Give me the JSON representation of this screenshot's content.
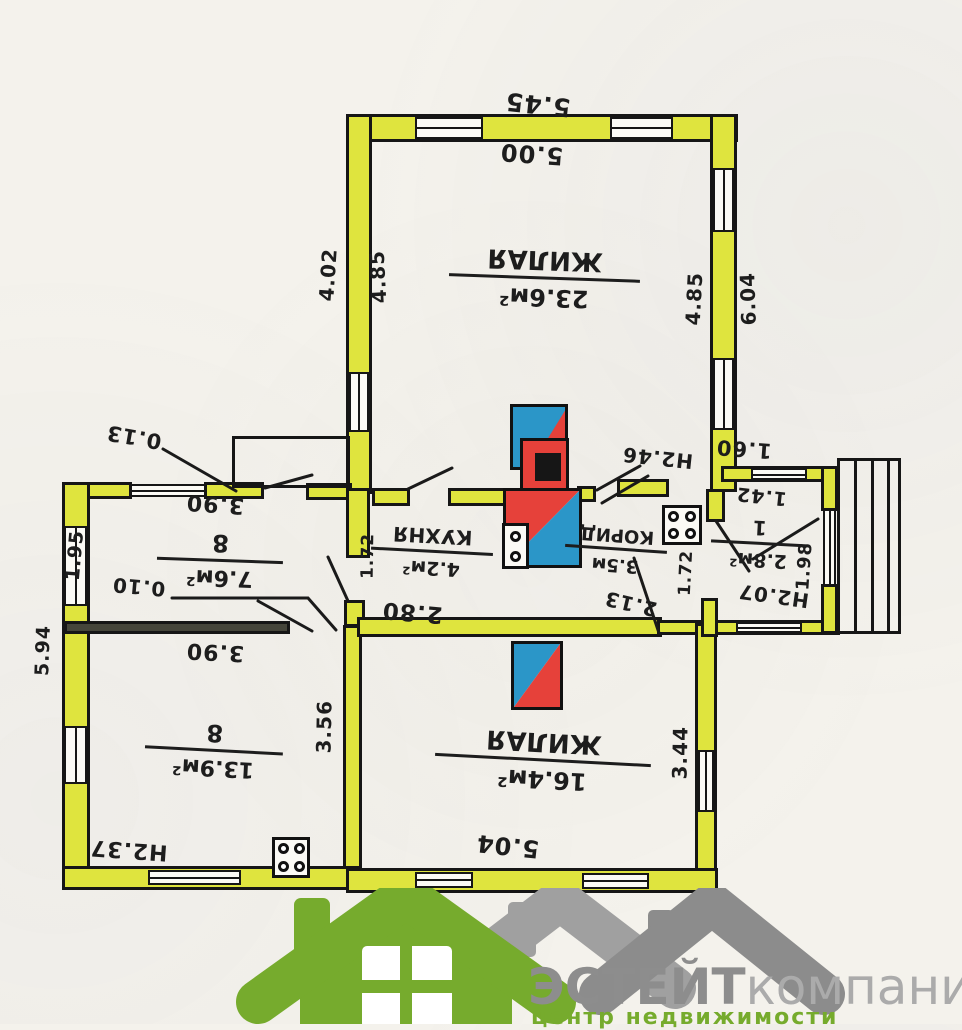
{
  "document": {
    "type": "hand-drawn floor plan (photographed upside down)",
    "orientation_note": "all plan lettering appears rotated 180°"
  },
  "plan": {
    "rooms": {
      "living_main": {
        "name": "ЖИЛАЯ",
        "area": "23.6м²"
      },
      "room_8a": {
        "name": "8",
        "area": "7.6м²"
      },
      "room_8b": {
        "name": "8",
        "area": "13.9м²"
      },
      "kitchen": {
        "name": "КУХНЯ",
        "area": "4.2м²"
      },
      "corridor": {
        "name": "КОРИД",
        "area": "3.5м"
      },
      "hall": {
        "name": "1",
        "area": "2.8м²"
      },
      "living_second": {
        "name": "ЖИЛАЯ",
        "area": "16.4м²"
      }
    },
    "dimensions": {
      "top_outer": "5.45",
      "top_inner": "5.00",
      "left_wall_outer": "4.02",
      "left_wall_inner": "4.85",
      "right_wall_inner": "4.85",
      "right_wall_outer": "6.04",
      "annex_wall_thickness": "0.13",
      "room8a_width": "3.90",
      "room8a_depth": "1.95",
      "partition_thickness": "0.10",
      "room8b_width": "3.90",
      "room8b_depth": "3.56",
      "room8b_height": "Н2.37",
      "annex_outer_left": "5.94",
      "kitchen_width": "1.72",
      "kitchen_span": "2.80",
      "kitchen_height": "Н2.46",
      "corridor_span": "2.13",
      "corridor_width": "1.72",
      "hall_outer": "1.60",
      "hall_inner": "1.42",
      "hall_depth": "1.98",
      "hall_height": "Н2.07",
      "room16_width": "5.04",
      "room16_depth": "3.44"
    },
    "colors": {
      "wall_fill": "#dfe43e",
      "stove_red": "#e6413a",
      "stove_blue": "#2b96c8",
      "ink": "#161616"
    }
  },
  "logo": {
    "brand_bold": "ЭСТЕЙТ",
    "brand_regular": "компани",
    "tagline": "центр недвижимости",
    "green": "#76ab2d",
    "gray_dark": "#8d8d8d",
    "gray_light": "#ababab"
  }
}
